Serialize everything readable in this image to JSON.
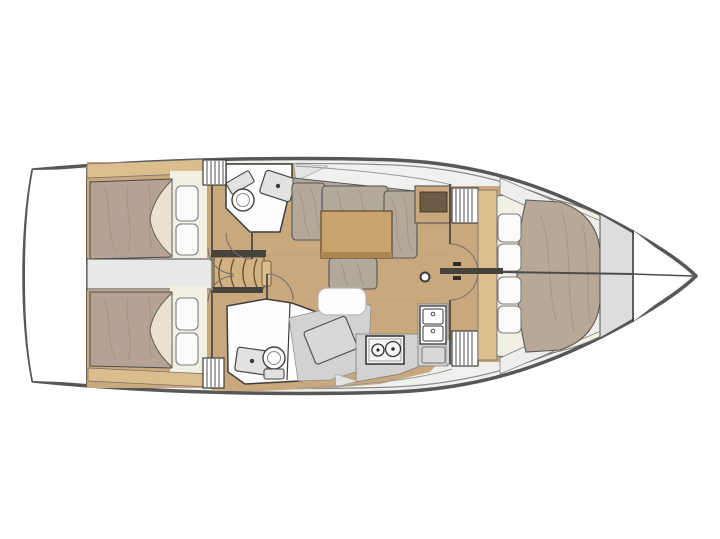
{
  "meta": {
    "title": "Sailboat interior layout floor plan",
    "type": "yacht-floor-plan",
    "orientation": "bow-right"
  },
  "colors": {
    "hull_outline": "#575757",
    "hull_inner_line": "#8a8a8a",
    "deck": "#f0f0ee",
    "white_area": "#ffffff",
    "wood_floor": "#c9a87d",
    "wood_trim": "#dcbd8e",
    "wood_step": "#d2b183",
    "table_wood": "#c9a36c",
    "table_edge": "#ad8652",
    "cabinet_wood": "#c9a87d",
    "cabinet_inset": "#6e5b45",
    "mattress": "#b5a294",
    "duvet": "#b7a898",
    "sheet": "#eae1d0",
    "pillow": "#fbfbfa",
    "cushion": "#b3a99b",
    "platform": "#f2efe4",
    "white_room": "#fdfdfd",
    "engine_room": "#e8e8e7",
    "counter": "#d2d2d1",
    "gray_unit": "#d8d8d7",
    "locker_gray": "#dddddc",
    "seat_white": "#fdfdfd",
    "dark_bar": "#46423c",
    "appliance_white": "#f7f7f6",
    "fixture_gray": "#e2e2e0"
  },
  "components": {
    "transom": "transom / swim platform",
    "aft_cabin_port": "aft double cabin (port)",
    "aft_cabin_starboard": "aft double cabin (starboard)",
    "engine_room": "engine compartment",
    "companionway": "companionway steps",
    "head_forward_port": "head with toilet and washbasin",
    "head_aft_starboard": "head with separate shower",
    "salon": "salon with L-settee and table",
    "nav_station": "chart table with seat",
    "galley": "galley with stove, double sink and lockers",
    "forward_cabin": "forward V-berth cabin",
    "bow_locker": "anchor locker"
  }
}
